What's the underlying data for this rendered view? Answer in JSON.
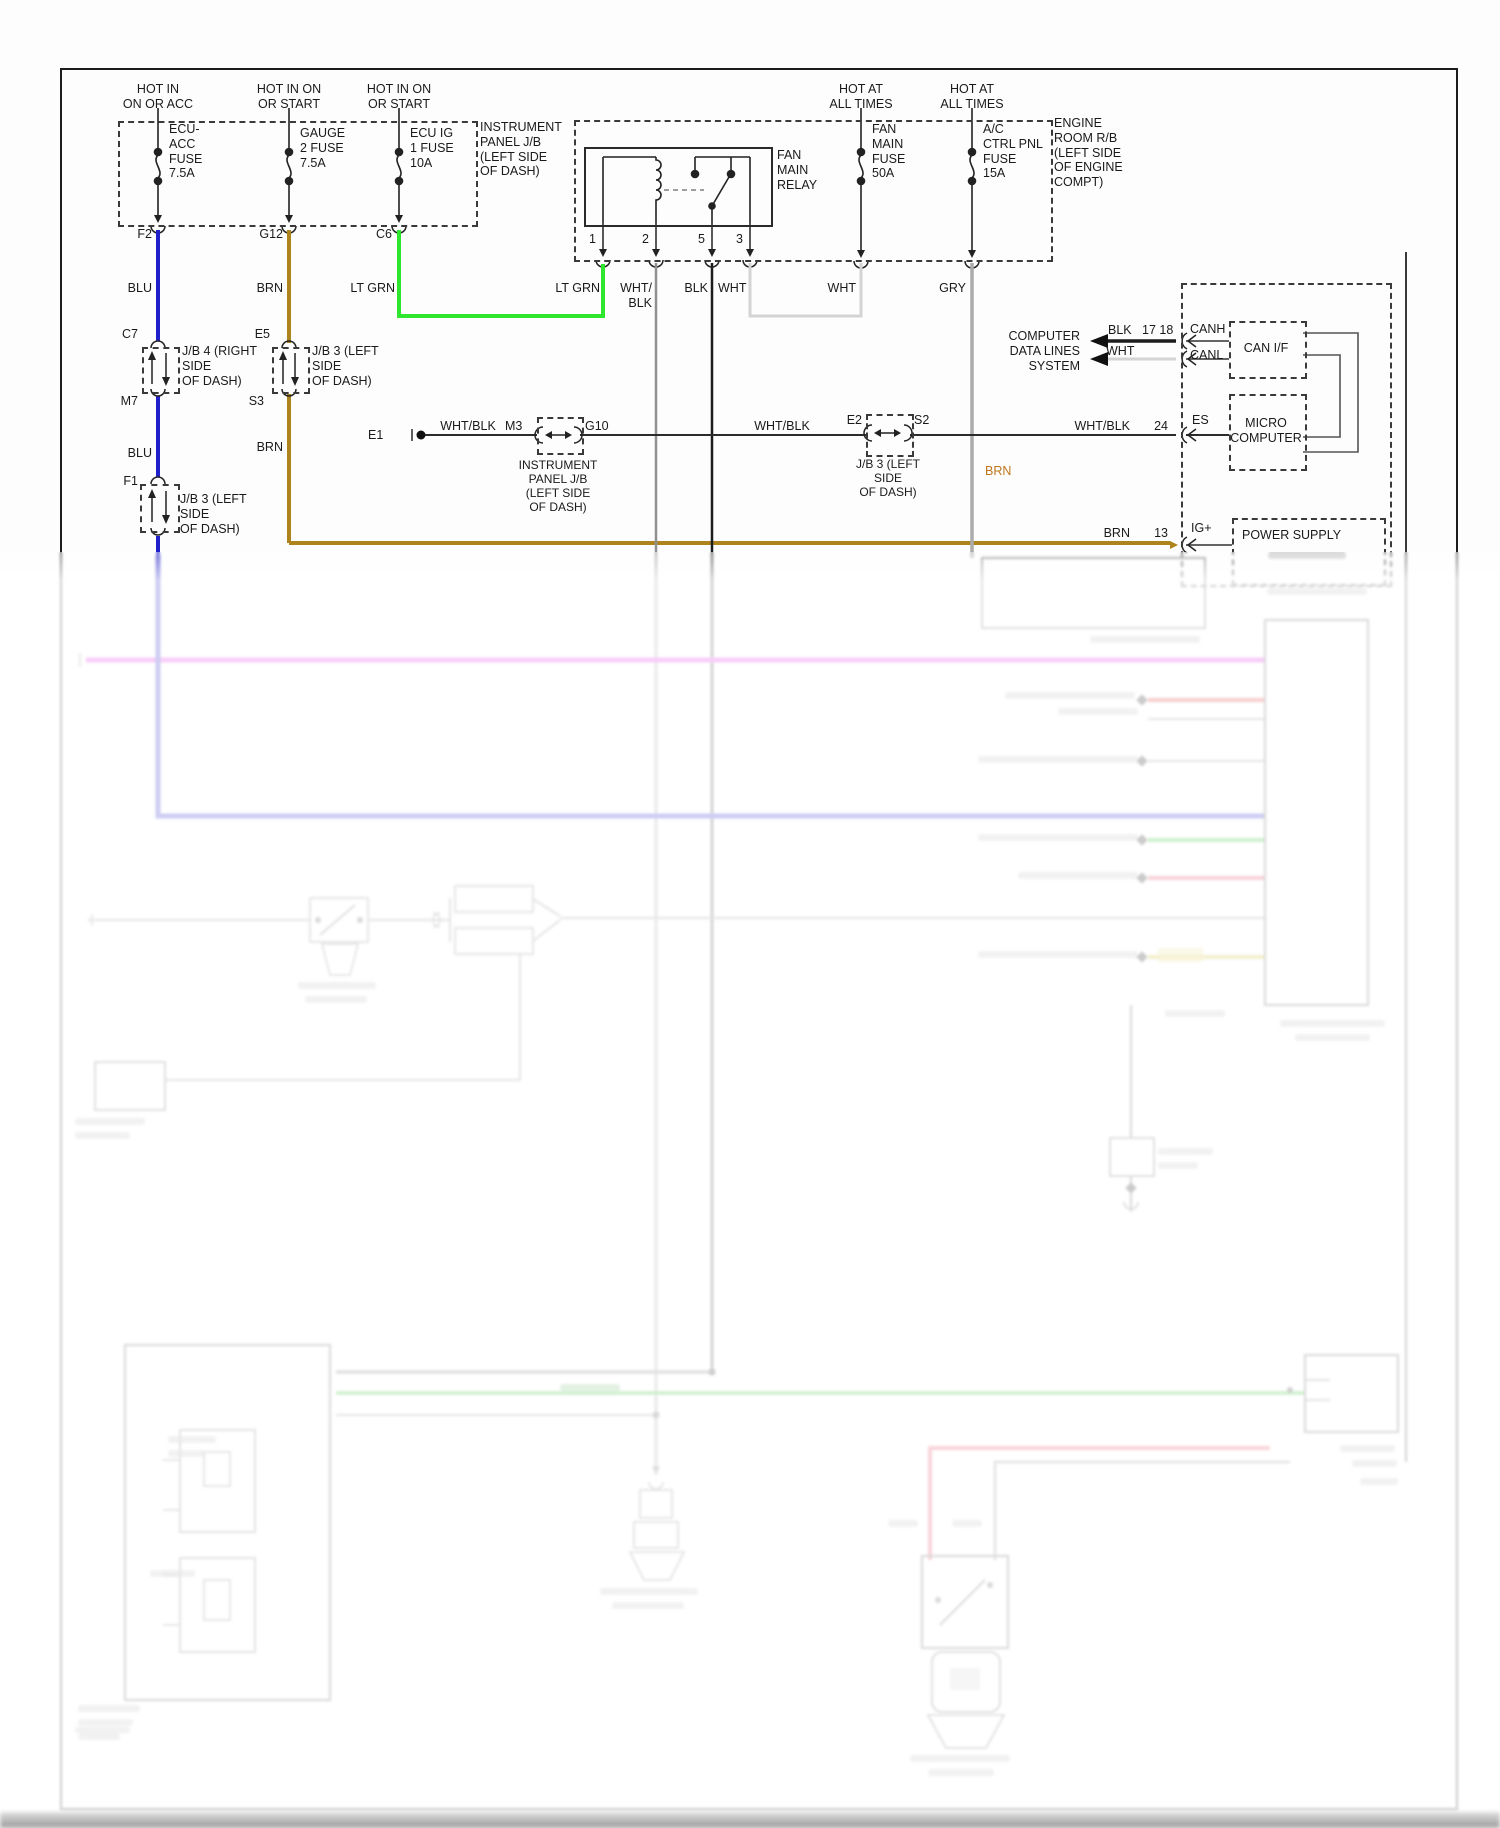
{
  "headers": {
    "h1": "HOT IN\nON OR ACC",
    "h2": "HOT IN ON\nOR START",
    "h3": "HOT IN ON\nOR START",
    "h4": "HOT AT\nALL TIMES",
    "h5": "HOT AT\nALL TIMES"
  },
  "fuses": {
    "ecu_acc": "ECU-\nACC\nFUSE\n7.5A",
    "gauge2": "GAUGE\n2 FUSE\n7.5A",
    "ecu_ig1": "ECU IG\n1 FUSE\n10A",
    "fan_main": "FAN\nMAIN\nFUSE\n50A",
    "ac_ctrl": "A/C\nCTRL PNL\nFUSE\n15A"
  },
  "blocks": {
    "instrument_panel_jb": "INSTRUMENT\nPANEL J/B\n(LEFT SIDE\nOF DASH)",
    "engine_room_rb": "ENGINE\nROOM R/B\n(LEFT SIDE\nOF ENGINE\nCOMPT)",
    "fan_main_relay": "FAN\nMAIN\nRELAY",
    "can_if": "CAN I/F",
    "micro_computer": "MICRO\nCOMPUTER",
    "power_supply": "POWER SUPPLY",
    "computer_data_lines": "COMPUTER\nDATA LINES\nSYSTEM"
  },
  "pins": {
    "p1": "1",
    "p2": "2",
    "p5": "5",
    "p3": "3"
  },
  "connectors": {
    "f2": "F2",
    "g12": "G12",
    "c6": "C6",
    "c7": "C7",
    "e5": "E5",
    "m7": "M7",
    "s3": "S3",
    "f1": "F1",
    "e1": "E1",
    "m3": "M3",
    "g10": "G10",
    "e2": "E2",
    "s2": "S2",
    "es": "ES",
    "ig": "IG+",
    "canh": "CANH",
    "canl": "CANL",
    "pins_1718": "17 18",
    "pin_24": "24",
    "pin_13": "13"
  },
  "wire_labels": {
    "blu_1": "BLU",
    "brn_1": "BRN",
    "ltgrn_1": "LT GRN",
    "ltgrn_2": "LT GRN",
    "whtblk_relay": "WHT/\nBLK",
    "blk_relay": "BLK",
    "wht_relay": "WHT",
    "wht_fan": "WHT",
    "gry": "GRY",
    "blu_2": "BLU",
    "brn_2": "BRN",
    "brn_3": "BRN",
    "brn_4": "BRN",
    "whtblk_1": "WHT/BLK",
    "whtblk_2": "WHT/BLK",
    "whtblk_3": "WHT/BLK",
    "blk_can": "BLK",
    "wht_can": "WHT"
  },
  "jb_captions": {
    "jb4_right": "J/B 4 (RIGHT\nSIDE\nOF DASH)",
    "jb3_left_e5": "J/B 3 (LEFT\nSIDE\nOF DASH)",
    "jb3_left_f1": "J/B 3 (LEFT\nSIDE\nOF DASH)",
    "ip_jb_m3": "INSTRUMENT\nPANEL J/B\n(LEFT SIDE\nOF DASH)",
    "jb3_left_e2": "J/B 3 (LEFT\nSIDE\nOF DASH)"
  },
  "colors": {
    "blu": "#2020c8",
    "brn": "#ad841c",
    "lt_grn": "#2ee62e",
    "wht": "#d4d4d4",
    "gry": "#ababab",
    "blk": "#1c1c1c",
    "wht_blk": "#909090",
    "faded_magenta": "#dd22dd",
    "faded_blue": "#2020c8",
    "faded_red": "#dd2222",
    "faded_green": "#22bb22",
    "faded_yellow": "#c8b820",
    "faded_pink": "#e04060"
  }
}
